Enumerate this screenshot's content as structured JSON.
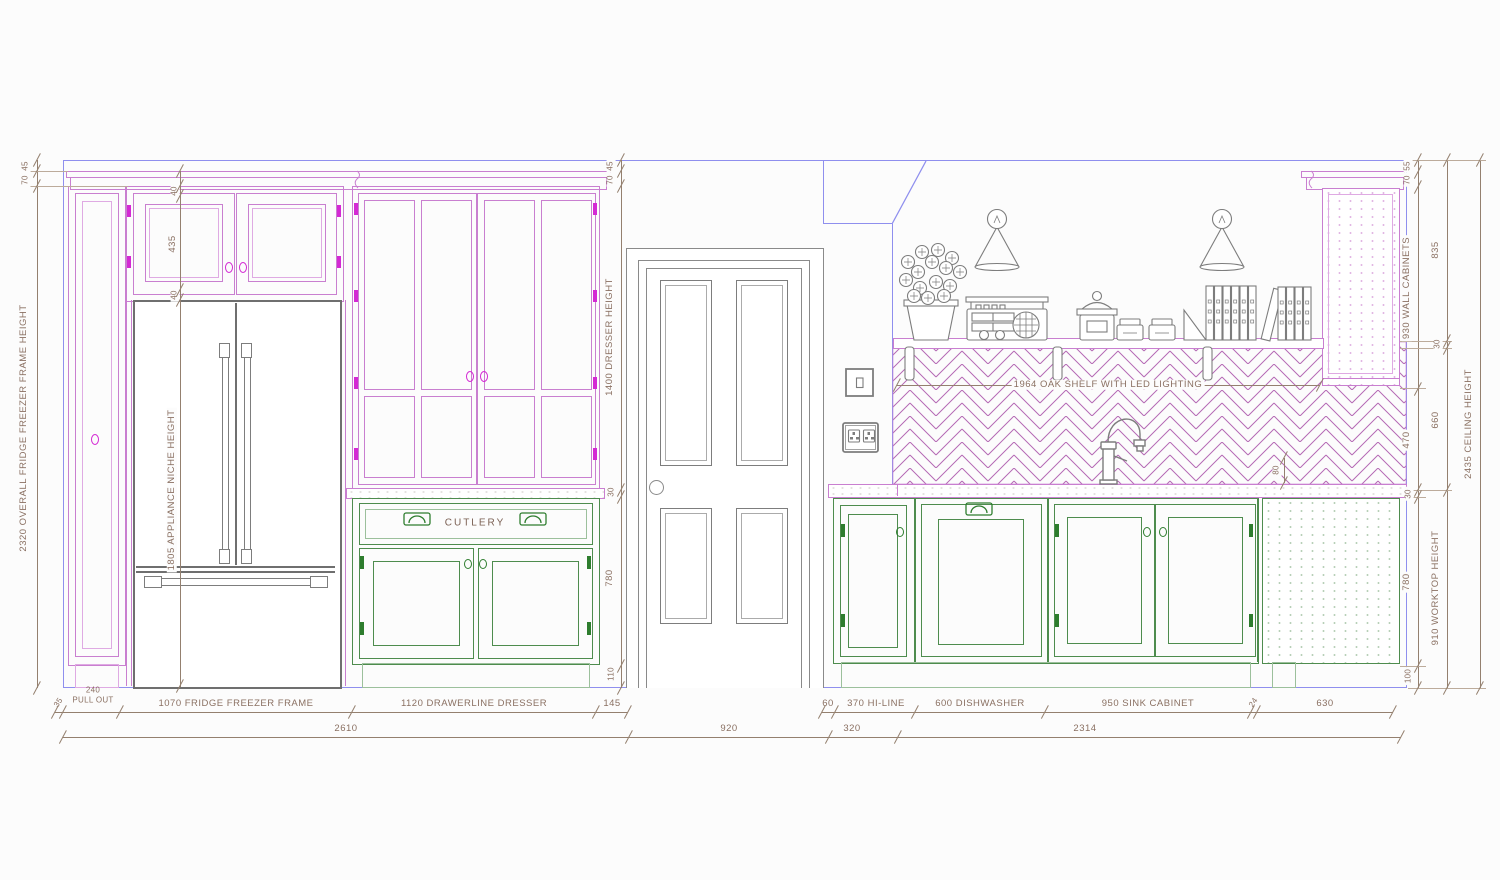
{
  "title": "Kitchen elevation drawing",
  "colors": {
    "cabinet_magenta": "#c97fd0",
    "hardware_magenta": "#d429d4",
    "cabinet_green": "#4e8c4e",
    "wall_blue": "#8f8fee",
    "dimension_brown": "#8a7062",
    "appliance_gray": "#7d7d7d",
    "tile_magenta": "#b469b4"
  },
  "dims": {
    "left": {
      "gap": "45",
      "cornice": "70",
      "overall": "2320 OVERALL FRIDGE FREEZER FRAME HEIGHT"
    },
    "cab": {
      "rail_top": "40",
      "door": "435",
      "rail_bottom": "40",
      "niche": "1805 APPLIANCE NICHE HEIGHT"
    },
    "door": {
      "gap": "45",
      "cornice": "70",
      "dresser": "1400 DRESSER HEIGHT",
      "worktop": "30",
      "base": "780",
      "plinth": "110"
    },
    "r1": {
      "gap": "55",
      "cornice": "70",
      "wall": "930 WALL CABINETS",
      "splash": "470",
      "worktop": "30",
      "base": "780",
      "plinth": "100"
    },
    "r2": {
      "upper": "835",
      "shelf": "30",
      "mid": "660",
      "height": "910 WORKTOP HEIGHT"
    },
    "r3": {
      "ceiling": "2435 CEILING HEIGHT"
    },
    "b1": {
      "filler": "35",
      "pull_val": "240",
      "pull_lbl": "PULL OUT",
      "fridge": "1070 FRIDGE FREEZER FRAME",
      "dresser": "1120 DRAWERLINE DRESSER",
      "end": "145"
    },
    "b2": {
      "wall": "60",
      "hiline": "370 HI-LINE",
      "dw": "600 DISHWASHER",
      "sink": "950 SINK CABINET",
      "filler": "24",
      "end": "630"
    },
    "b3": {
      "left": "2610",
      "door": "920",
      "gap": "320",
      "right": "2314"
    },
    "shelf": "1964 OAK SHELF WITH LED LIGHTING",
    "overhang": "80"
  },
  "labels": {
    "cutlery": "CUTLERY"
  }
}
